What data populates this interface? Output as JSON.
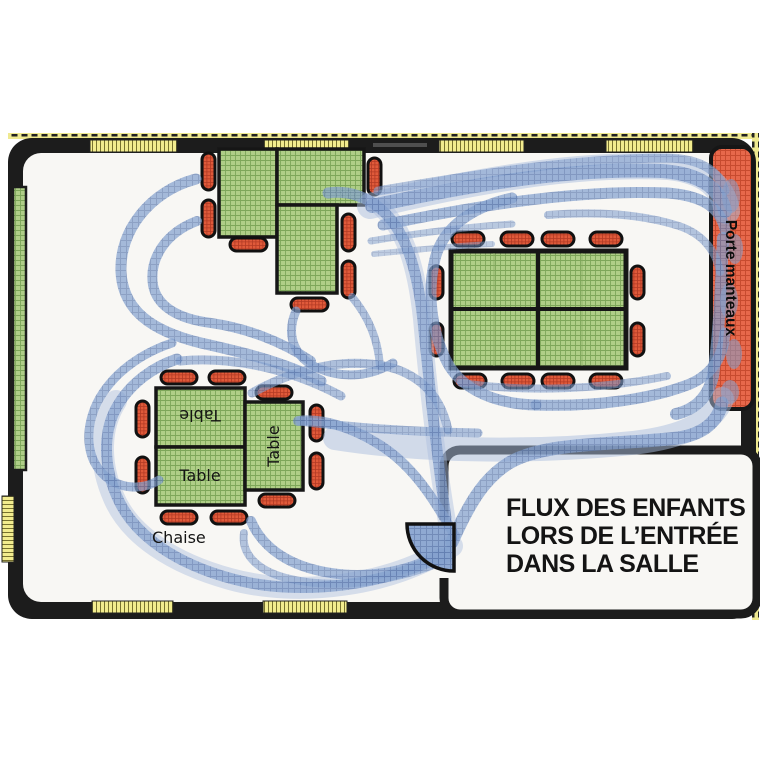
{
  "diagram": {
    "title": {
      "line1": "FLUX DES ENFANTS",
      "line2": "LORS DE L’ENTRÉE",
      "line3": "DANS LA SALLE"
    },
    "labels": {
      "table": "Table",
      "chair": "Chaise",
      "coat_rack": "Porte manteaux"
    },
    "colors": {
      "wall": "#1c1c1c",
      "room_floor": "#f8f7f4",
      "table_green": "#afce87",
      "table_grid": "#7da659",
      "chair_red": "#e05a3a",
      "coat_rack_red": "#e7684b",
      "flow_blue": "#84a1ce",
      "flow_blue_light": "#aabddd",
      "window_yellow": "#f2ec8e"
    }
  }
}
